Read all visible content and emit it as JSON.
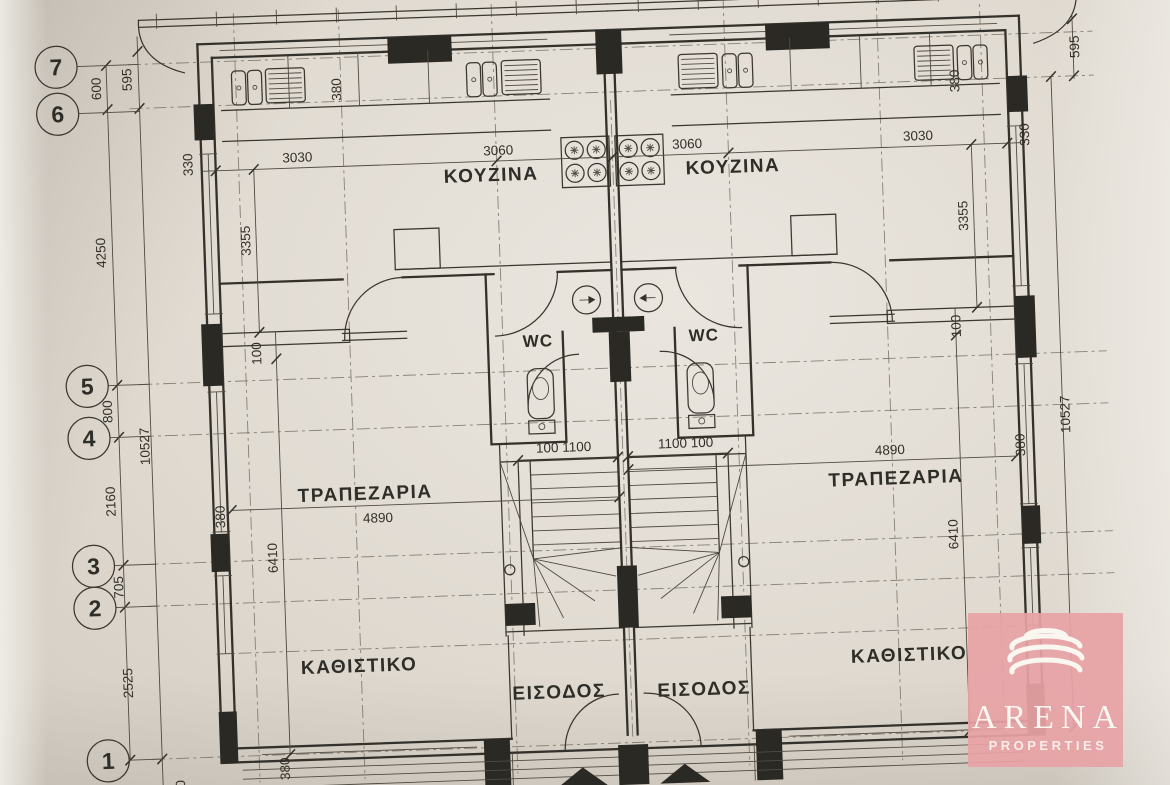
{
  "title": "Architectural floor plan - ground floor, two mirrored units",
  "colors": {
    "paper": "#ddd7ce",
    "ink": "#34312b",
    "watermark_pink": "#e7a3a6",
    "watermark_text": "#faf6f0"
  },
  "grid": {
    "bubbles": [
      "7",
      "6",
      "5",
      "4",
      "3",
      "2",
      "1"
    ]
  },
  "rooms": {
    "kitchen": "ΚΟΥΖΙΝΑ",
    "dining": "ΤΡΑΠΕΖΑΡΙΑ",
    "living": "ΚΑΘΙΣΤΙΚΟ",
    "entrance": "ΕΙΣΟΔΟΣ",
    "wc": "WC"
  },
  "dims": {
    "v600": "600",
    "v595": "595",
    "v4250": "4250",
    "v800": "800",
    "v2160": "2160",
    "v705": "705",
    "v2525": "2525",
    "v10527": "10527",
    "h3030": "3030",
    "h3060": "3060",
    "v3355": "3355",
    "v330": "330",
    "v380": "380",
    "v100": "100",
    "h4890": "4890",
    "v6410": "6410",
    "stair_left": "100 1100",
    "stair_right": "1100 100",
    "bottom_partial": "800"
  },
  "watermark": {
    "title": "ARENA",
    "subtitle": "PROPERTIES",
    "logo_icon": "coil-rings-icon"
  }
}
